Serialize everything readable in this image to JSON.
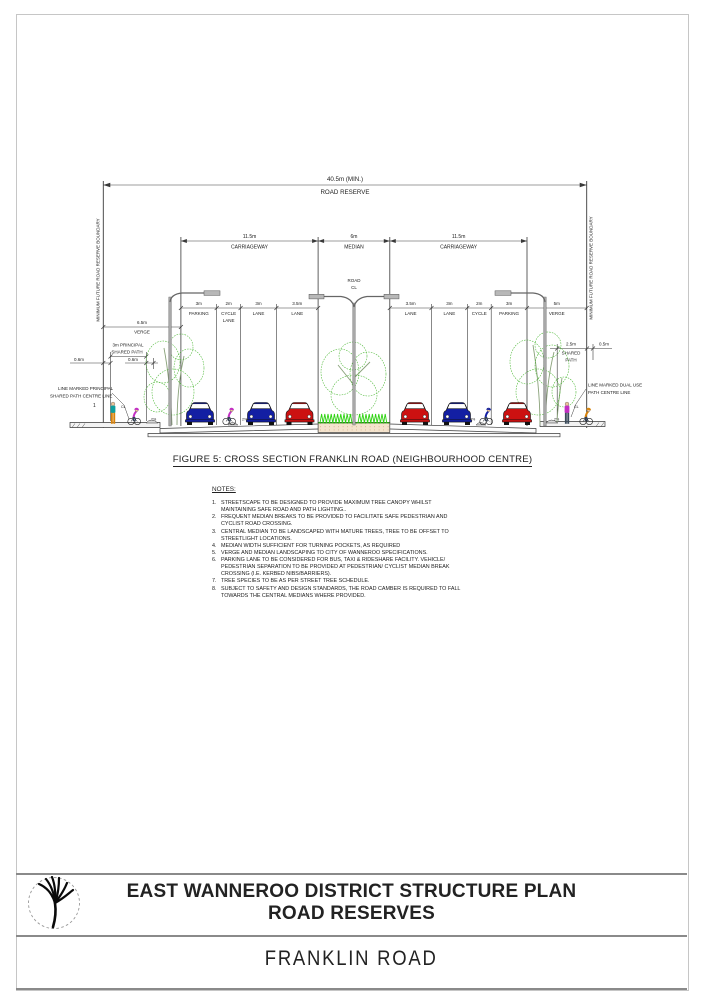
{
  "page": {
    "caption": "FIGURE 5: CROSS SECTION FRANKLIN ROAD (NEIGHBOURHOOD CENTRE)"
  },
  "drawing": {
    "road_reserve": {
      "dim": "40.5m (MIN.)",
      "label": "ROAD RESERVE"
    },
    "boundary_label_left": "MINIMUM FUTURE ROAD RESERVE BOUNDARY",
    "boundary_label_right": "MINIMUM FUTURE ROAD RESERVE BOUNDARY",
    "carriageway_left": {
      "dim": "11.5m",
      "label": "CARRIAGEWAY"
    },
    "median": {
      "dim": "6m",
      "label": "MEDIAN"
    },
    "carriageway_right": {
      "dim": "11.5m",
      "label": "CARRIAGEWAY"
    },
    "road_cl": {
      "line1": "ROAD",
      "line2": "CL"
    },
    "lanes": [
      {
        "dim": "3m",
        "label": "PARKING"
      },
      {
        "dim": "2m",
        "label": "CYCLE",
        "label2": "LANE"
      },
      {
        "dim": "3m",
        "label": "LANE"
      },
      {
        "dim": "3.5m",
        "label": "LANE"
      },
      {
        "dim": "3.5m",
        "label": "LANE"
      },
      {
        "dim": "3m",
        "label": "LANE"
      },
      {
        "dim": "2m",
        "label": "CYCLE",
        "label2": "LANE"
      },
      {
        "dim": "3m",
        "label": "PARKING"
      },
      {
        "dim": "5m",
        "label": "VERGE"
      }
    ],
    "left_verge": {
      "dim": "6.5m",
      "label": "VERGE"
    },
    "left_path": {
      "dim_line1": "3m PRINCIPAL",
      "dim_line2": "SHARED PATH",
      "offset_left": "0.6m",
      "offset_right": "0.6m",
      "callout1": "LINE MARKED PRINCIPAL",
      "callout2": "SHARED PATH CENTRE LINE",
      "cl": "CL"
    },
    "right_path": {
      "dim1": "2.5m",
      "dim_line2": "SHARED",
      "dim_line3": "PATH",
      "offset": "0.5m",
      "callout1": "LINE MARKED DUAL USE",
      "callout2": "PATH CENTRE LINE",
      "cl": "CL"
    },
    "slope": "2%",
    "marker_one": "1"
  },
  "notes": {
    "heading": "NOTES:",
    "items": [
      {
        "num": "1.",
        "text": "STREETSCAPE TO BE DESIGNED TO PROVIDE MAXIMUM TREE CANOPY WHILST MAINTAINING SAFE ROAD AND PATH LIGHTING.."
      },
      {
        "num": "2.",
        "text": "FREQUENT MEDIAN BREAKS TO BE PROVIDED TO FACILITATE SAFE PEDESTRIAN AND CYCLIST ROAD CROSSING."
      },
      {
        "num": "3.",
        "text": "CENTRAL MEDIAN TO BE LANDSCAPED WITH MATURE TREES, TREE TO BE OFFSET TO STREETLIGHT LOCATIONS."
      },
      {
        "num": "4.",
        "text": "MEDIAN WIDTH SUFFICIENT FOR TURNING POCKETS, AS REQUIRED"
      },
      {
        "num": "5.",
        "text": "VERGE AND MEDIAN LANDSCAPING TO CITY OF WANNEROO SPECIFICATIONS."
      },
      {
        "num": "6.",
        "text": "PARKING LANE TO BE CONSIDERED FOR BUS, TAXI & RIDESHARE FACILITY. VEHICLE/ PEDESTRIAN SEPARATION TO BE PROVIDED AT PEDESTRIAN/ CYCLIST MEDIAN BREAK CROSSING (I.E. KERBED NIBS/BARRIERS)."
      },
      {
        "num": "7.",
        "text": "TREE SPECIES TO BE AS PER STREET TREE SCHEDULE."
      },
      {
        "num": "8.",
        "text": "SUBJECT TO SAFETY AND DESIGN STANDARDS, THE ROAD CAMBER IS REQUIRED TO FALL TOWARDS THE CENTRAL MEDIANS WHERE PROVIDED."
      }
    ]
  },
  "title_block": {
    "line1": "EAST WANNEROO DISTRICT STRUCTURE PLAN",
    "line2": "ROAD RESERVES",
    "subtitle": "FRANKLIN ROAD"
  },
  "colors": {
    "car_blue": "#131fa3",
    "car_red": "#cc1111",
    "tree": "#44b52c",
    "grass": "#2fd312",
    "grass_dark": "#1a8a08",
    "median_tan": "#f4e3cd",
    "magenta": "#c32fc3",
    "yellow": "#d4c410",
    "teal": "#0e9f9f",
    "orange": "#d8820a",
    "pole": "#a8a8a8"
  }
}
